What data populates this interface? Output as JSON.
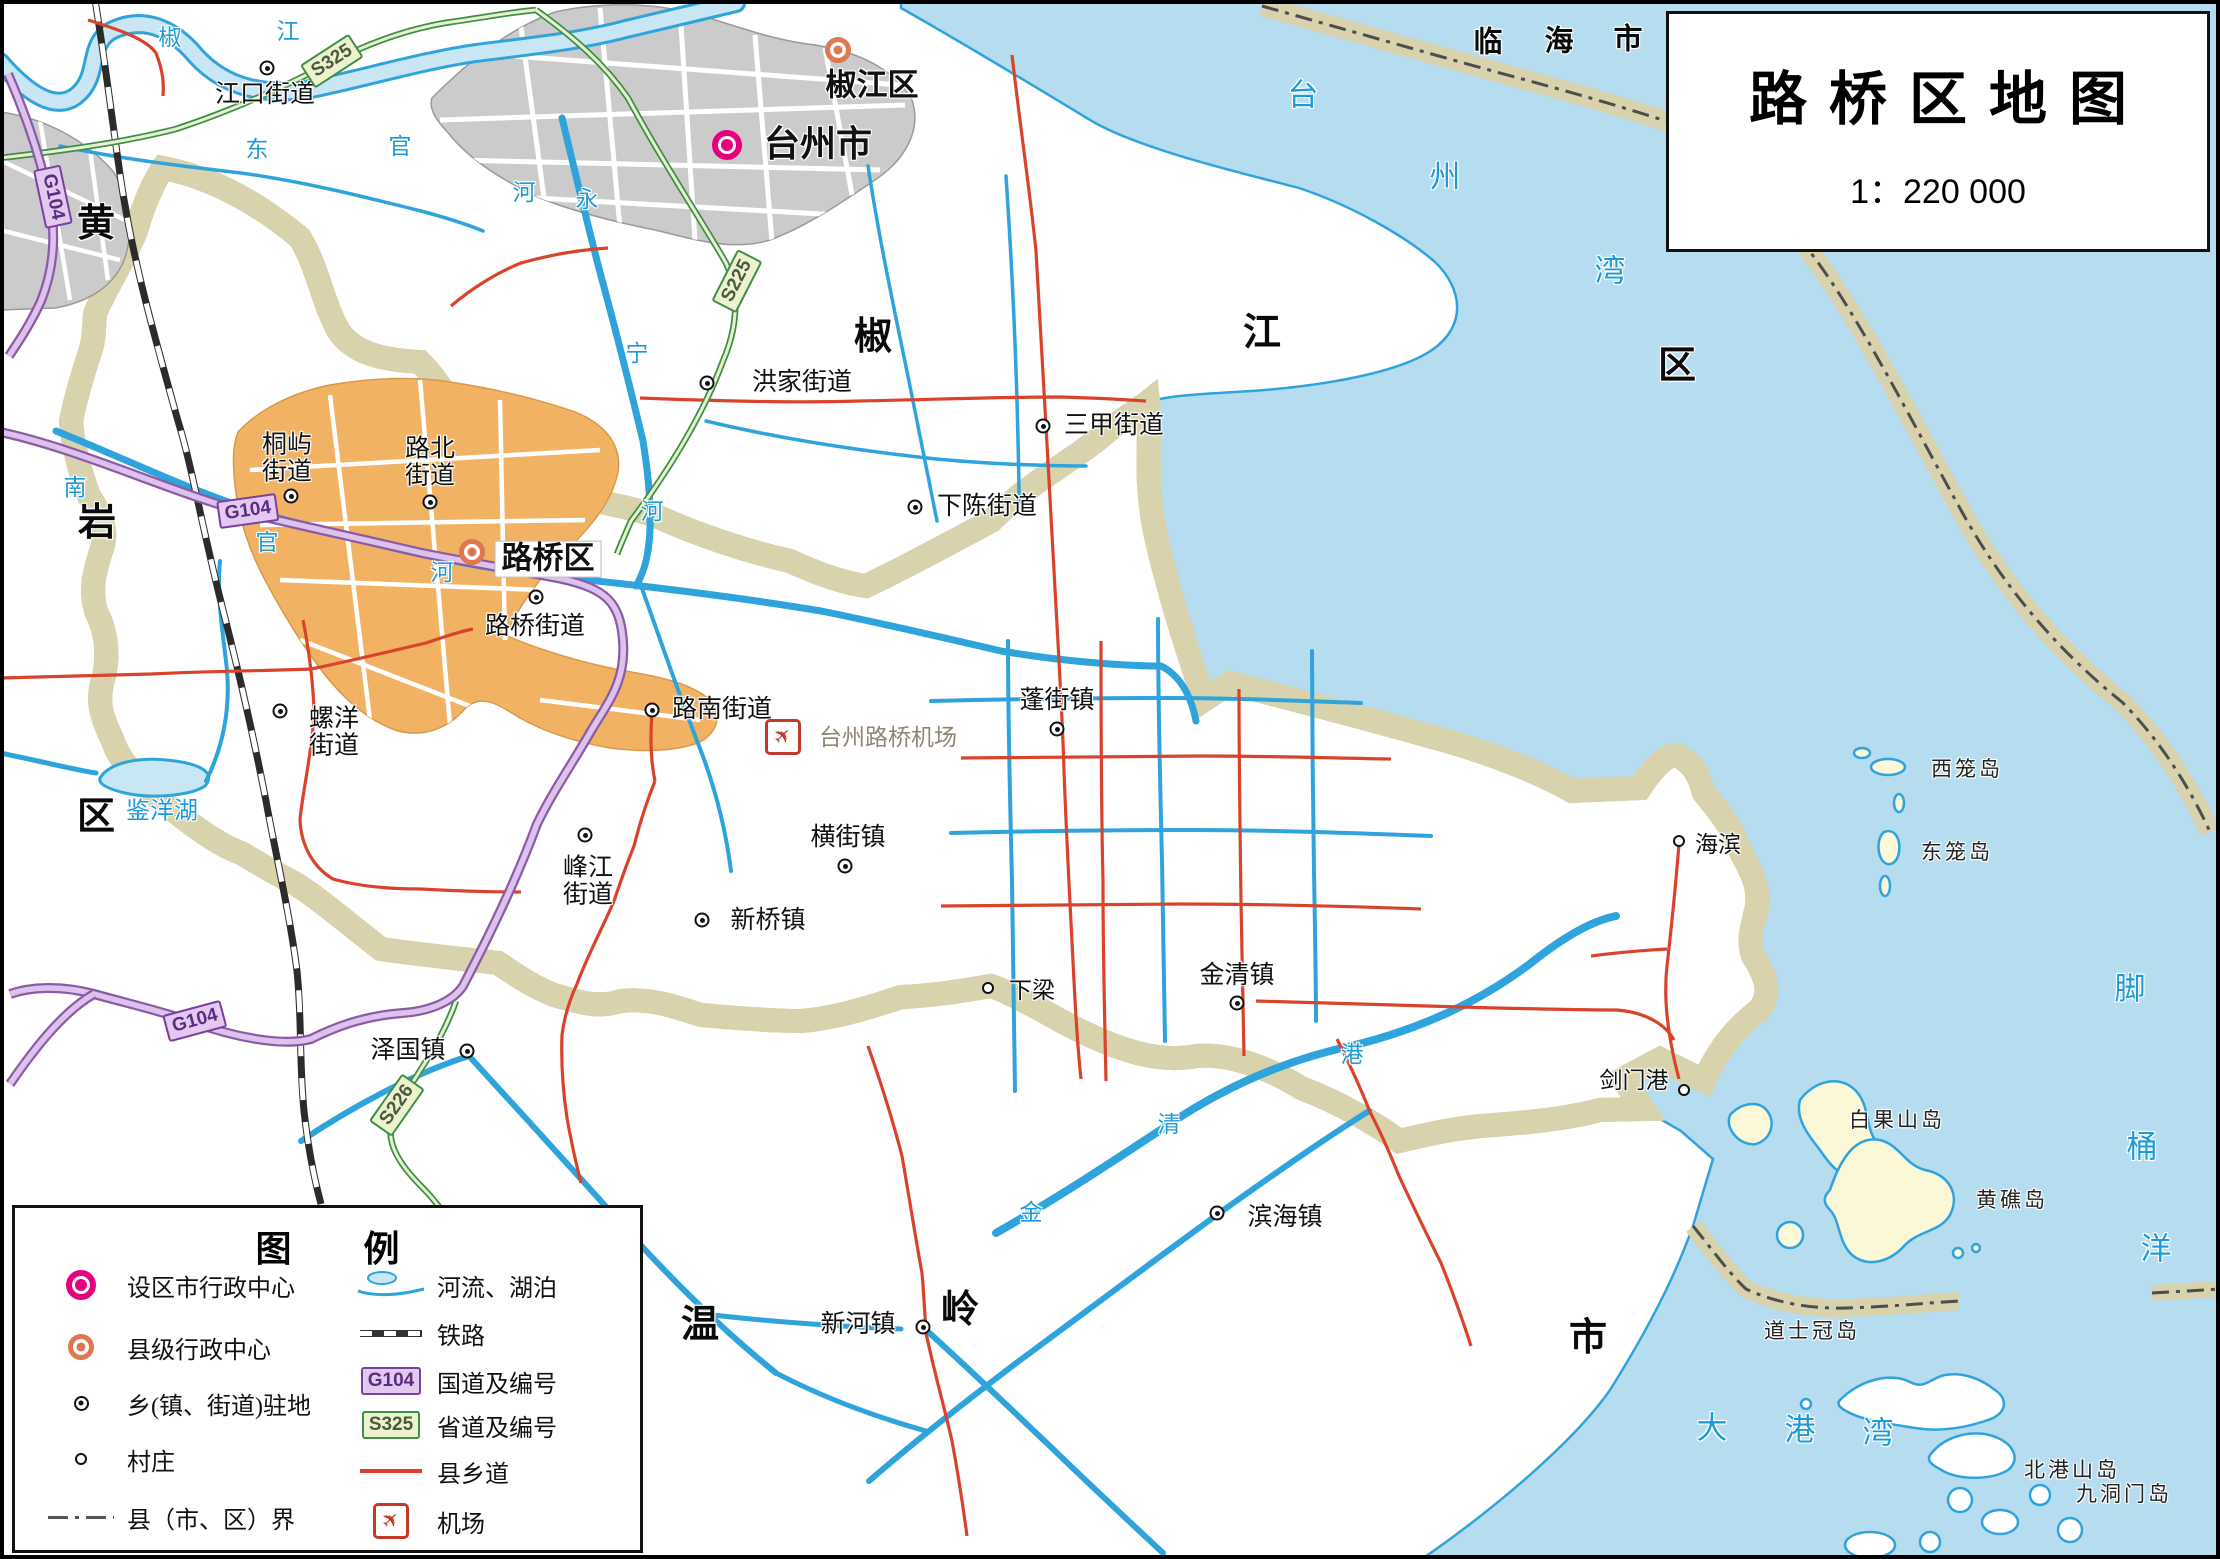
{
  "title_box": {
    "title": "路桥区地图",
    "scale": "1：220 000"
  },
  "legend": {
    "title": "图　　例",
    "left_items": [
      {
        "icon": "city-marker-icon",
        "label": "设区市行政中心"
      },
      {
        "icon": "county-marker-icon",
        "label": "县级行政中心"
      },
      {
        "icon": "town-marker-icon",
        "label": "乡(镇、街道)驻地"
      },
      {
        "icon": "village-marker-icon",
        "label": "村庄"
      },
      {
        "icon": "boundary-line-icon",
        "label": "县（市、区）界"
      }
    ],
    "right_items": [
      {
        "icon": "river-lake-icon",
        "label": "河流、湖泊"
      },
      {
        "icon": "railway-icon",
        "label": "铁路"
      },
      {
        "icon": "national-road-icon",
        "label": "国道及编号",
        "code": "G104"
      },
      {
        "icon": "provincial-road-icon",
        "label": "省道及编号",
        "code": "S325"
      },
      {
        "icon": "county-road-icon",
        "label": "县乡道"
      },
      {
        "icon": "airport-icon",
        "label": "机场"
      }
    ]
  },
  "colors": {
    "sea": "#B5DCEF",
    "district_fill": "#FBF8D8",
    "boundary_band": "#CBC592",
    "national_road": "#8B5CA5",
    "provincial_road": "#3E8F47",
    "county_road": "#D9432C",
    "river": "#2FA3DC",
    "city_marker": "#E6007E",
    "county_marker": "#DD7850",
    "urban_gray": "#CBCBCB",
    "urban_orange": "#F2B264"
  },
  "map": {
    "markers": [
      {
        "kind": "city",
        "x": 727,
        "y": 145
      },
      {
        "kind": "county",
        "x": 838,
        "y": 50
      },
      {
        "kind": "county",
        "x": 472,
        "y": 552
      },
      {
        "kind": "town",
        "x": 267,
        "y": 68
      },
      {
        "kind": "town",
        "x": 707,
        "y": 383
      },
      {
        "kind": "town",
        "x": 1043,
        "y": 426
      },
      {
        "kind": "town",
        "x": 915,
        "y": 507
      },
      {
        "kind": "town",
        "x": 291,
        "y": 496
      },
      {
        "kind": "town",
        "x": 430,
        "y": 502
      },
      {
        "kind": "town",
        "x": 536,
        "y": 597
      },
      {
        "kind": "town",
        "x": 652,
        "y": 710
      },
      {
        "kind": "town",
        "x": 280,
        "y": 711
      },
      {
        "kind": "town",
        "x": 585,
        "y": 835
      },
      {
        "kind": "town",
        "x": 845,
        "y": 866
      },
      {
        "kind": "town",
        "x": 702,
        "y": 920
      },
      {
        "kind": "town",
        "x": 467,
        "y": 1051
      },
      {
        "kind": "town",
        "x": 1057,
        "y": 729
      },
      {
        "kind": "town",
        "x": 1237,
        "y": 1003
      },
      {
        "kind": "town",
        "x": 1217,
        "y": 1213
      },
      {
        "kind": "town",
        "x": 923,
        "y": 1327
      },
      {
        "kind": "village",
        "x": 988,
        "y": 988
      },
      {
        "kind": "village",
        "x": 1679,
        "y": 841
      },
      {
        "kind": "village",
        "x": 1684,
        "y": 1090
      }
    ],
    "labels": [
      {
        "text": "台州市",
        "x": 818,
        "y": 144,
        "cls": "city"
      },
      {
        "text": "椒江区",
        "x": 872,
        "y": 86,
        "cls": "county"
      },
      {
        "text": "路桥区",
        "x": 548,
        "y": 559,
        "cls": "district-seat"
      },
      {
        "text": "江口街道",
        "x": 265,
        "y": 95,
        "cls": "town"
      },
      {
        "text": "洪家街道",
        "x": 802,
        "y": 383,
        "cls": "town"
      },
      {
        "text": "三甲街道",
        "x": 1114,
        "y": 426,
        "cls": "town"
      },
      {
        "text": "下陈街道",
        "x": 987,
        "y": 507,
        "cls": "town"
      },
      {
        "text": "桐屿\n街道",
        "x": 287,
        "y": 459,
        "cls": "town"
      },
      {
        "text": "路北\n街道",
        "x": 430,
        "y": 463,
        "cls": "town"
      },
      {
        "text": "路桥街道",
        "x": 535,
        "y": 627,
        "cls": "town"
      },
      {
        "text": "路南街道",
        "x": 722,
        "y": 710,
        "cls": "town"
      },
      {
        "text": "螺洋\n街道",
        "x": 334,
        "y": 733,
        "cls": "town"
      },
      {
        "text": "峰江\n街道",
        "x": 588,
        "y": 882,
        "cls": "town"
      },
      {
        "text": "横街镇",
        "x": 848,
        "y": 838,
        "cls": "town"
      },
      {
        "text": "新桥镇",
        "x": 768,
        "y": 921,
        "cls": "town"
      },
      {
        "text": "泽国镇",
        "x": 408,
        "y": 1051,
        "cls": "town"
      },
      {
        "text": "蓬街镇",
        "x": 1057,
        "y": 701,
        "cls": "town"
      },
      {
        "text": "金清镇",
        "x": 1237,
        "y": 976,
        "cls": "town"
      },
      {
        "text": "滨海镇",
        "x": 1285,
        "y": 1218,
        "cls": "town"
      },
      {
        "text": "新河镇",
        "x": 858,
        "y": 1325,
        "cls": "town"
      },
      {
        "text": "下梁",
        "x": 1032,
        "y": 991,
        "cls": "village"
      },
      {
        "text": "海滨",
        "x": 1718,
        "y": 845,
        "cls": "village"
      },
      {
        "text": "剑门港",
        "x": 1634,
        "y": 1081,
        "cls": "village"
      },
      {
        "text": "台州路桥机场",
        "x": 888,
        "y": 738,
        "cls": "airport-name"
      },
      {
        "text": "黄",
        "x": 96,
        "y": 224,
        "cls": "bigdist"
      },
      {
        "text": "岩",
        "x": 97,
        "y": 523,
        "cls": "bigdist"
      },
      {
        "text": "区",
        "x": 96,
        "y": 817,
        "cls": "bigdist"
      },
      {
        "text": "椒",
        "x": 873,
        "y": 337,
        "cls": "bigdist"
      },
      {
        "text": "江",
        "x": 1262,
        "y": 333,
        "cls": "bigdist"
      },
      {
        "text": "区",
        "x": 1677,
        "y": 366,
        "cls": "bigdist"
      },
      {
        "text": "温",
        "x": 700,
        "y": 1325,
        "cls": "bigdist"
      },
      {
        "text": "岭",
        "x": 960,
        "y": 1310,
        "cls": "bigdist"
      },
      {
        "text": "市",
        "x": 1588,
        "y": 1338,
        "cls": "bigdist"
      },
      {
        "text": "临",
        "x": 1488,
        "y": 43,
        "cls": "neighbor"
      },
      {
        "text": "海",
        "x": 1559,
        "y": 42,
        "cls": "neighbor"
      },
      {
        "text": "市",
        "x": 1628,
        "y": 40,
        "cls": "neighbor"
      },
      {
        "text": "台",
        "x": 1303,
        "y": 96,
        "cls": "sea"
      },
      {
        "text": "州",
        "x": 1445,
        "y": 178,
        "cls": "sea"
      },
      {
        "text": "湾",
        "x": 1610,
        "y": 272,
        "cls": "sea"
      },
      {
        "text": "脚",
        "x": 2130,
        "y": 990,
        "cls": "sea"
      },
      {
        "text": "桶",
        "x": 2142,
        "y": 1148,
        "cls": "sea"
      },
      {
        "text": "洋",
        "x": 2156,
        "y": 1250,
        "cls": "sea"
      },
      {
        "text": "大",
        "x": 1712,
        "y": 1429,
        "cls": "sea"
      },
      {
        "text": "港",
        "x": 1800,
        "y": 1431,
        "cls": "sea"
      },
      {
        "text": "湾",
        "x": 1878,
        "y": 1434,
        "cls": "sea"
      },
      {
        "text": "椒",
        "x": 170,
        "y": 38,
        "cls": "river"
      },
      {
        "text": "江",
        "x": 288,
        "y": 32,
        "cls": "river"
      },
      {
        "text": "东",
        "x": 257,
        "y": 150,
        "cls": "river"
      },
      {
        "text": "官",
        "x": 400,
        "y": 147,
        "cls": "river"
      },
      {
        "text": "河",
        "x": 524,
        "y": 193,
        "cls": "river"
      },
      {
        "text": "永",
        "x": 587,
        "y": 200,
        "cls": "river"
      },
      {
        "text": "宁",
        "x": 637,
        "y": 354,
        "cls": "river"
      },
      {
        "text": "河",
        "x": 652,
        "y": 512,
        "cls": "river"
      },
      {
        "text": "南",
        "x": 75,
        "y": 488,
        "cls": "river"
      },
      {
        "text": "官",
        "x": 267,
        "y": 543,
        "cls": "river"
      },
      {
        "text": "河",
        "x": 442,
        "y": 573,
        "cls": "river"
      },
      {
        "text": "金",
        "x": 1031,
        "y": 1213,
        "cls": "river"
      },
      {
        "text": "清",
        "x": 1169,
        "y": 1125,
        "cls": "river"
      },
      {
        "text": "港",
        "x": 1352,
        "y": 1055,
        "cls": "river"
      },
      {
        "text": "鉴洋湖",
        "x": 162,
        "y": 812,
        "cls": "lake"
      },
      {
        "text": "西笼岛",
        "x": 1967,
        "y": 769,
        "cls": "island"
      },
      {
        "text": "东笼岛",
        "x": 1957,
        "y": 852,
        "cls": "island"
      },
      {
        "text": "白果山岛",
        "x": 1897,
        "y": 1120,
        "cls": "island"
      },
      {
        "text": "黄礁岛",
        "x": 2012,
        "y": 1200,
        "cls": "island"
      },
      {
        "text": "道士冠岛",
        "x": 1812,
        "y": 1331,
        "cls": "island"
      },
      {
        "text": "北港山岛",
        "x": 2072,
        "y": 1470,
        "cls": "island"
      },
      {
        "text": "九洞门岛",
        "x": 2124,
        "y": 1494,
        "cls": "island"
      }
    ],
    "shields": [
      {
        "code": "G104",
        "x": 53,
        "y": 197,
        "rot": 78,
        "kind": "national"
      },
      {
        "code": "G104",
        "x": 248,
        "y": 511,
        "rot": -8,
        "kind": "national"
      },
      {
        "code": "G104",
        "x": 195,
        "y": 1021,
        "rot": -15,
        "kind": "national"
      },
      {
        "code": "S325",
        "x": 332,
        "y": 61,
        "rot": -33,
        "kind": "provincial"
      },
      {
        "code": "S225",
        "x": 737,
        "y": 281,
        "rot": -63,
        "kind": "provincial"
      },
      {
        "code": "S226",
        "x": 397,
        "y": 1105,
        "rot": -55,
        "kind": "provincial"
      }
    ],
    "airports": [
      {
        "x": 783,
        "y": 737
      }
    ]
  }
}
